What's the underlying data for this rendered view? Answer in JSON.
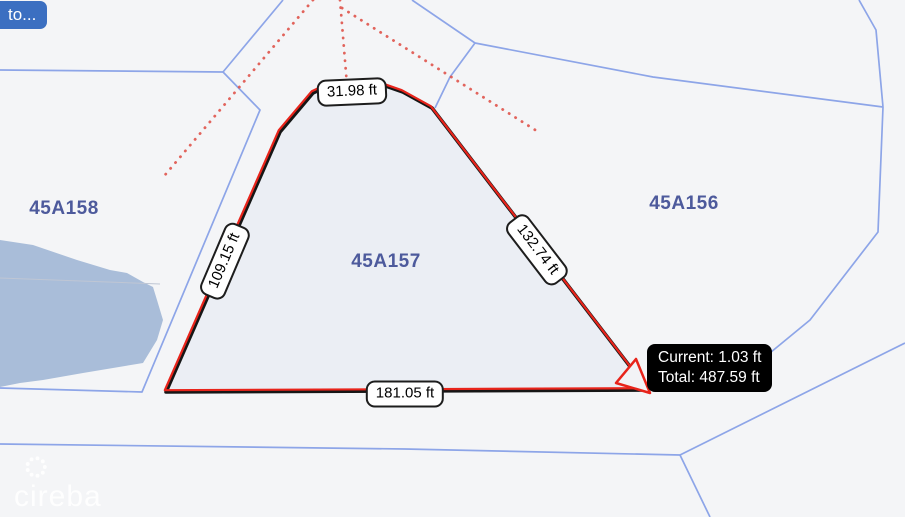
{
  "header": {
    "back_button_label": "to..."
  },
  "map": {
    "parcel_labels": [
      {
        "id": "45A158"
      },
      {
        "id": "45A157"
      },
      {
        "id": "45A156"
      }
    ],
    "measure_tool": {
      "segment_labels": {
        "top": "31.98 ft",
        "left": "109.15 ft",
        "right": "132.74 ft",
        "bottom": "181.05 ft"
      },
      "tooltip": {
        "current": "Current: 1.03 ft",
        "total": "Total: 487.59 ft"
      }
    },
    "watermark_text": "cireba",
    "colors": {
      "background": "#f4f5f7",
      "parcel_line": "#8da5e8",
      "parcel_label": "#4d5a9c",
      "water": "#a9bdd9",
      "measured_parcel_fill": "#ebeef4",
      "measure_line_red": "#e8241b",
      "measure_line_dark": "#161616",
      "survey_ray_red": "#e0544b",
      "button_blue": "#3b6fc1",
      "tooltip_bg": "#000000"
    }
  }
}
